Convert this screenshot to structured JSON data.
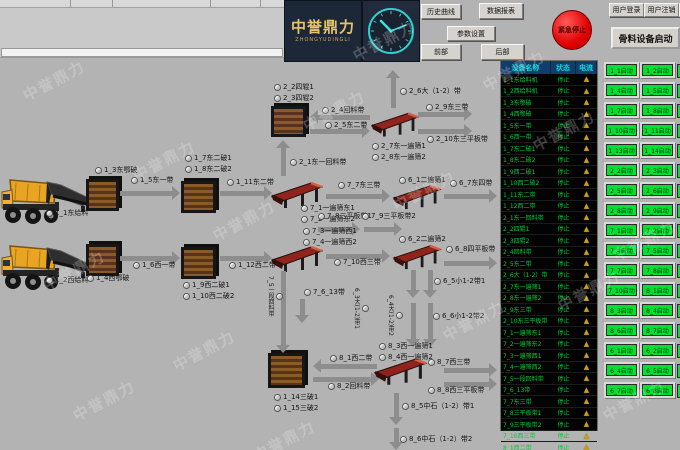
{
  "watermark": "中誉鼎力",
  "logo": {
    "name": "中誉鼎力",
    "sub": "ZHONGYUDINGLI"
  },
  "toolbar": {
    "history": "历史曲线",
    "report": "数据报表",
    "params": "参数设置",
    "front": "前部",
    "rear": "后部"
  },
  "emergency_label": "紧急停止",
  "user": {
    "login": "用户登录",
    "logout": "用户注销"
  },
  "right_panel": {
    "title": "骨料设备启动",
    "start_buttons": [
      [
        "1_1启动",
        "1_2启动"
      ],
      [
        "1_4启动",
        "1_5启动"
      ],
      [
        "1_7启动",
        "1_8启动"
      ],
      [
        "1_10启动",
        "1_11启动"
      ],
      [
        "1_13启动",
        "1_14启动"
      ],
      [
        "2_2启动",
        "2_3启动"
      ],
      [
        "2_5启动",
        "2_6启动"
      ],
      [
        "2_8启动",
        "2_9启动"
      ],
      [
        "7_1启动",
        "7_2启动"
      ],
      [
        "7_4启动",
        "7_5启动"
      ],
      [
        "7_7启动",
        "7_8启动"
      ],
      [
        "7_10启动",
        "8_1启动"
      ],
      [
        "8_3启动",
        "8_4启动"
      ],
      [
        "8_6启动",
        "8_7启动"
      ],
      [
        "6_1启动",
        "6_2启动"
      ],
      [
        "6_4启动",
        "6_5启动"
      ],
      [
        "6_7启动",
        "6_8启动"
      ]
    ]
  },
  "status_table": {
    "headers": [
      "设备名称",
      "状态",
      "电流"
    ],
    "rows": [
      {
        "name": "1_1东给料机",
        "status": "停止"
      },
      {
        "name": "1_2西给料机",
        "status": "停止"
      },
      {
        "name": "1_3东鄂破",
        "status": "停止"
      },
      {
        "name": "1_4西鄂破",
        "status": "停止"
      },
      {
        "name": "1_5东一带",
        "status": "停止"
      },
      {
        "name": "1_6西一带",
        "status": "停止"
      },
      {
        "name": "1_7东二破1",
        "status": "停止"
      },
      {
        "name": "1_8东二破2",
        "status": "停止"
      },
      {
        "name": "1_9西二破1",
        "status": "停止"
      },
      {
        "name": "1_10西二破2",
        "status": "停止"
      },
      {
        "name": "1_11东二带",
        "status": "停止"
      },
      {
        "name": "1_12西二带",
        "status": "停止"
      },
      {
        "name": "2_1东一回料带",
        "status": "停止"
      },
      {
        "name": "2_2四辊1",
        "status": "停止"
      },
      {
        "name": "2_3四辊2",
        "status": "停止"
      },
      {
        "name": "2_4回料带",
        "status": "停止"
      },
      {
        "name": "2_5东二带",
        "status": "停止"
      },
      {
        "name": "2_6大（1-2）带",
        "status": "停止"
      },
      {
        "name": "2_7东一遍筛1",
        "status": "停止"
      },
      {
        "name": "2_8东一遍筛2",
        "status": "停止"
      },
      {
        "name": "2_9东三带",
        "status": "停止"
      },
      {
        "name": "2_10东三平板带",
        "status": "停止"
      },
      {
        "name": "7_1一遍筛东1",
        "status": "停止"
      },
      {
        "name": "7_2一遍筛东2",
        "status": "停止"
      },
      {
        "name": "7_3一遍筛西1",
        "status": "停止"
      },
      {
        "name": "7_4一遍筛西2",
        "status": "停止"
      },
      {
        "name": "7_5一段回料带",
        "status": "停止"
      },
      {
        "name": "7_6_13带",
        "status": "停止"
      },
      {
        "name": "7_7东三带",
        "status": "停止"
      },
      {
        "name": "7_8三平板带1",
        "status": "停止"
      },
      {
        "name": "7_9三平板带2",
        "status": "停止"
      },
      {
        "name": "7_10西三带",
        "status": "停止"
      },
      {
        "name": "8_1西二带",
        "status": "停止"
      },
      {
        "name": "8_2回料带",
        "status": "停止"
      }
    ]
  },
  "diagram": {
    "nodes": [
      {
        "type": "truck",
        "x": 0,
        "y": 173,
        "w": 62,
        "h": 52
      },
      {
        "type": "truck",
        "x": 0,
        "y": 239,
        "w": 62,
        "h": 52
      },
      {
        "type": "feeder",
        "x": 45,
        "y": 180,
        "w": 48,
        "h": 32
      },
      {
        "type": "feeder",
        "x": 45,
        "y": 246,
        "w": 48,
        "h": 32
      },
      {
        "type": "crusher",
        "x": 86,
        "y": 179,
        "w": 33,
        "h": 32
      },
      {
        "type": "crusher",
        "x": 86,
        "y": 244,
        "w": 33,
        "h": 32
      },
      {
        "type": "crusher",
        "x": 181,
        "y": 181,
        "w": 35,
        "h": 32
      },
      {
        "type": "crusher",
        "x": 181,
        "y": 247,
        "w": 35,
        "h": 32
      },
      {
        "type": "crusher",
        "x": 271,
        "y": 106,
        "w": 35,
        "h": 31
      },
      {
        "type": "crusher",
        "x": 268,
        "y": 353,
        "w": 37,
        "h": 35
      },
      {
        "type": "screen",
        "x": 271,
        "y": 181,
        "w": 52,
        "h": 28
      },
      {
        "type": "screen",
        "x": 271,
        "y": 245,
        "w": 52,
        "h": 28
      },
      {
        "type": "screen",
        "x": 371,
        "y": 111,
        "w": 48,
        "h": 27
      },
      {
        "type": "screen",
        "x": 391,
        "y": 184,
        "w": 52,
        "h": 26
      },
      {
        "type": "screen",
        "x": 391,
        "y": 244,
        "w": 52,
        "h": 26
      },
      {
        "type": "screen",
        "x": 374,
        "y": 357,
        "w": 53,
        "h": 29
      }
    ],
    "labels": [
      {
        "t": "1_1东给料",
        "x": 46,
        "y": 209
      },
      {
        "t": "1_2西给料",
        "x": 46,
        "y": 276
      },
      {
        "t": "1_3东鄂破",
        "x": 95,
        "y": 166
      },
      {
        "t": "1_4西鄂破",
        "x": 87,
        "y": 274
      },
      {
        "t": "1_5东一带",
        "x": 131,
        "y": 176
      },
      {
        "t": "1_6西一带",
        "x": 133,
        "y": 261
      },
      {
        "t": "1_7东二破1",
        "x": 185,
        "y": 154
      },
      {
        "t": "1_8东二破2",
        "x": 185,
        "y": 165
      },
      {
        "t": "1_9西二破1",
        "x": 183,
        "y": 281
      },
      {
        "t": "1_10西二破2",
        "x": 183,
        "y": 292
      },
      {
        "t": "1_11东二带",
        "x": 227,
        "y": 178
      },
      {
        "t": "1_12西二带",
        "x": 229,
        "y": 261
      },
      {
        "t": "2_2四辊1",
        "x": 274,
        "y": 83
      },
      {
        "t": "2_3四辊2",
        "x": 274,
        "y": 94
      },
      {
        "t": "2_4回料带",
        "x": 322,
        "y": 106
      },
      {
        "t": "2_5东二带",
        "x": 325,
        "y": 121
      },
      {
        "t": "2_1东一回料带",
        "x": 290,
        "y": 158
      },
      {
        "t": "2_6大（1-2）带",
        "x": 400,
        "y": 87
      },
      {
        "t": "2_9东三带",
        "x": 426,
        "y": 103
      },
      {
        "t": "2_10东三平板带",
        "x": 427,
        "y": 135
      },
      {
        "t": "2_7东一遍筛1",
        "x": 372,
        "y": 142
      },
      {
        "t": "2_8东一遍筛2",
        "x": 372,
        "y": 153
      },
      {
        "t": "7_1一遍筛东1",
        "x": 301,
        "y": 204
      },
      {
        "t": "7_2一遍筛东2",
        "x": 301,
        "y": 215
      },
      {
        "t": "7_3一遍筛西1",
        "x": 303,
        "y": 227
      },
      {
        "t": "7_4一遍筛西2",
        "x": 303,
        "y": 238
      },
      {
        "t": "7_7东三带",
        "x": 338,
        "y": 181
      },
      {
        "t": "6_1二遍筛1",
        "x": 399,
        "y": 176
      },
      {
        "t": "6_7东四带",
        "x": 450,
        "y": 179
      },
      {
        "t": "7_8三平板带1",
        "x": 318,
        "y": 212
      },
      {
        "t": "7_9三平板带2",
        "x": 362,
        "y": 212
      },
      {
        "t": "7_10西三带",
        "x": 334,
        "y": 258
      },
      {
        "t": "6_2二遍筛2",
        "x": 399,
        "y": 235
      },
      {
        "t": "6_8四平板带",
        "x": 446,
        "y": 245
      },
      {
        "t": "6_5小1-2带1",
        "x": 434,
        "y": 277
      },
      {
        "t": "6_6小1-2带2",
        "x": 433,
        "y": 312
      },
      {
        "t": "6_3大(1-2)带1",
        "x": 352,
        "y": 288,
        "v": 1
      },
      {
        "t": "6_4大(1-2)带2",
        "x": 386,
        "y": 295,
        "v": 1
      },
      {
        "t": "7_5一段回料带",
        "x": 266,
        "y": 276,
        "v": 1
      },
      {
        "t": "7_6_13带",
        "x": 304,
        "y": 288
      },
      {
        "t": "8_3西一遍筛1",
        "x": 379,
        "y": 342
      },
      {
        "t": "8_4西一遍筛2",
        "x": 379,
        "y": 353
      },
      {
        "t": "8_1西二带",
        "x": 330,
        "y": 354
      },
      {
        "t": "8_2回料带",
        "x": 328,
        "y": 382
      },
      {
        "t": "1_14三破1",
        "x": 274,
        "y": 393
      },
      {
        "t": "1_15三破2",
        "x": 274,
        "y": 404
      },
      {
        "t": "8_7西三带",
        "x": 428,
        "y": 358
      },
      {
        "t": "8_8西三平板带",
        "x": 428,
        "y": 386
      },
      {
        "t": "8_5中石（1-2）带1",
        "x": 402,
        "y": 402
      },
      {
        "t": "8_6中石（1-2）带2",
        "x": 400,
        "y": 435
      }
    ],
    "arrows": [
      {
        "d": "r",
        "x": 120,
        "y": 193,
        "len": 60
      },
      {
        "d": "r",
        "x": 120,
        "y": 258,
        "len": 60
      },
      {
        "d": "r",
        "x": 220,
        "y": 193,
        "len": 52
      },
      {
        "d": "r",
        "x": 220,
        "y": 258,
        "len": 52
      },
      {
        "d": "u",
        "x": 283,
        "y": 140,
        "len": 36
      },
      {
        "d": "l",
        "x": 310,
        "y": 117,
        "len": 60
      },
      {
        "d": "r",
        "x": 310,
        "y": 131,
        "len": 60
      },
      {
        "d": "u",
        "x": 393,
        "y": 70,
        "len": 38
      },
      {
        "d": "r",
        "x": 418,
        "y": 114,
        "len": 54
      },
      {
        "d": "r",
        "x": 418,
        "y": 131,
        "len": 54
      },
      {
        "d": "r",
        "x": 326,
        "y": 196,
        "len": 64
      },
      {
        "d": "r",
        "x": 444,
        "y": 196,
        "len": 53
      },
      {
        "d": "r",
        "x": 318,
        "y": 229,
        "len": 42
      },
      {
        "d": "r",
        "x": 364,
        "y": 229,
        "len": 38
      },
      {
        "d": "r",
        "x": 326,
        "y": 256,
        "len": 64
      },
      {
        "d": "r",
        "x": 444,
        "y": 263,
        "len": 53
      },
      {
        "d": "d",
        "x": 413,
        "y": 270,
        "len": 28
      },
      {
        "d": "d",
        "x": 430,
        "y": 270,
        "len": 28
      },
      {
        "d": "d",
        "x": 413,
        "y": 303,
        "len": 44
      },
      {
        "d": "d",
        "x": 430,
        "y": 303,
        "len": 44
      },
      {
        "d": "d",
        "x": 283,
        "y": 271,
        "len": 82
      },
      {
        "d": "d",
        "x": 302,
        "y": 299,
        "len": 24
      },
      {
        "d": "l",
        "x": 313,
        "y": 366,
        "len": 64
      },
      {
        "d": "r",
        "x": 313,
        "y": 379,
        "len": 66
      },
      {
        "d": "r",
        "x": 444,
        "y": 370,
        "len": 53
      },
      {
        "d": "r",
        "x": 444,
        "y": 384,
        "len": 53
      },
      {
        "d": "d",
        "x": 396,
        "y": 393,
        "len": 32
      },
      {
        "d": "d",
        "x": 396,
        "y": 428,
        "len": 22
      }
    ]
  },
  "colors": {
    "emergency_red": "#e00000",
    "start_green": "#00e132",
    "status_green": "#00cc33",
    "table_header_blue": "#123c6b",
    "table_header_text": "#00dcdc",
    "logo_gold": "#e8c468",
    "arrow_gray": "#8d8d8d"
  }
}
